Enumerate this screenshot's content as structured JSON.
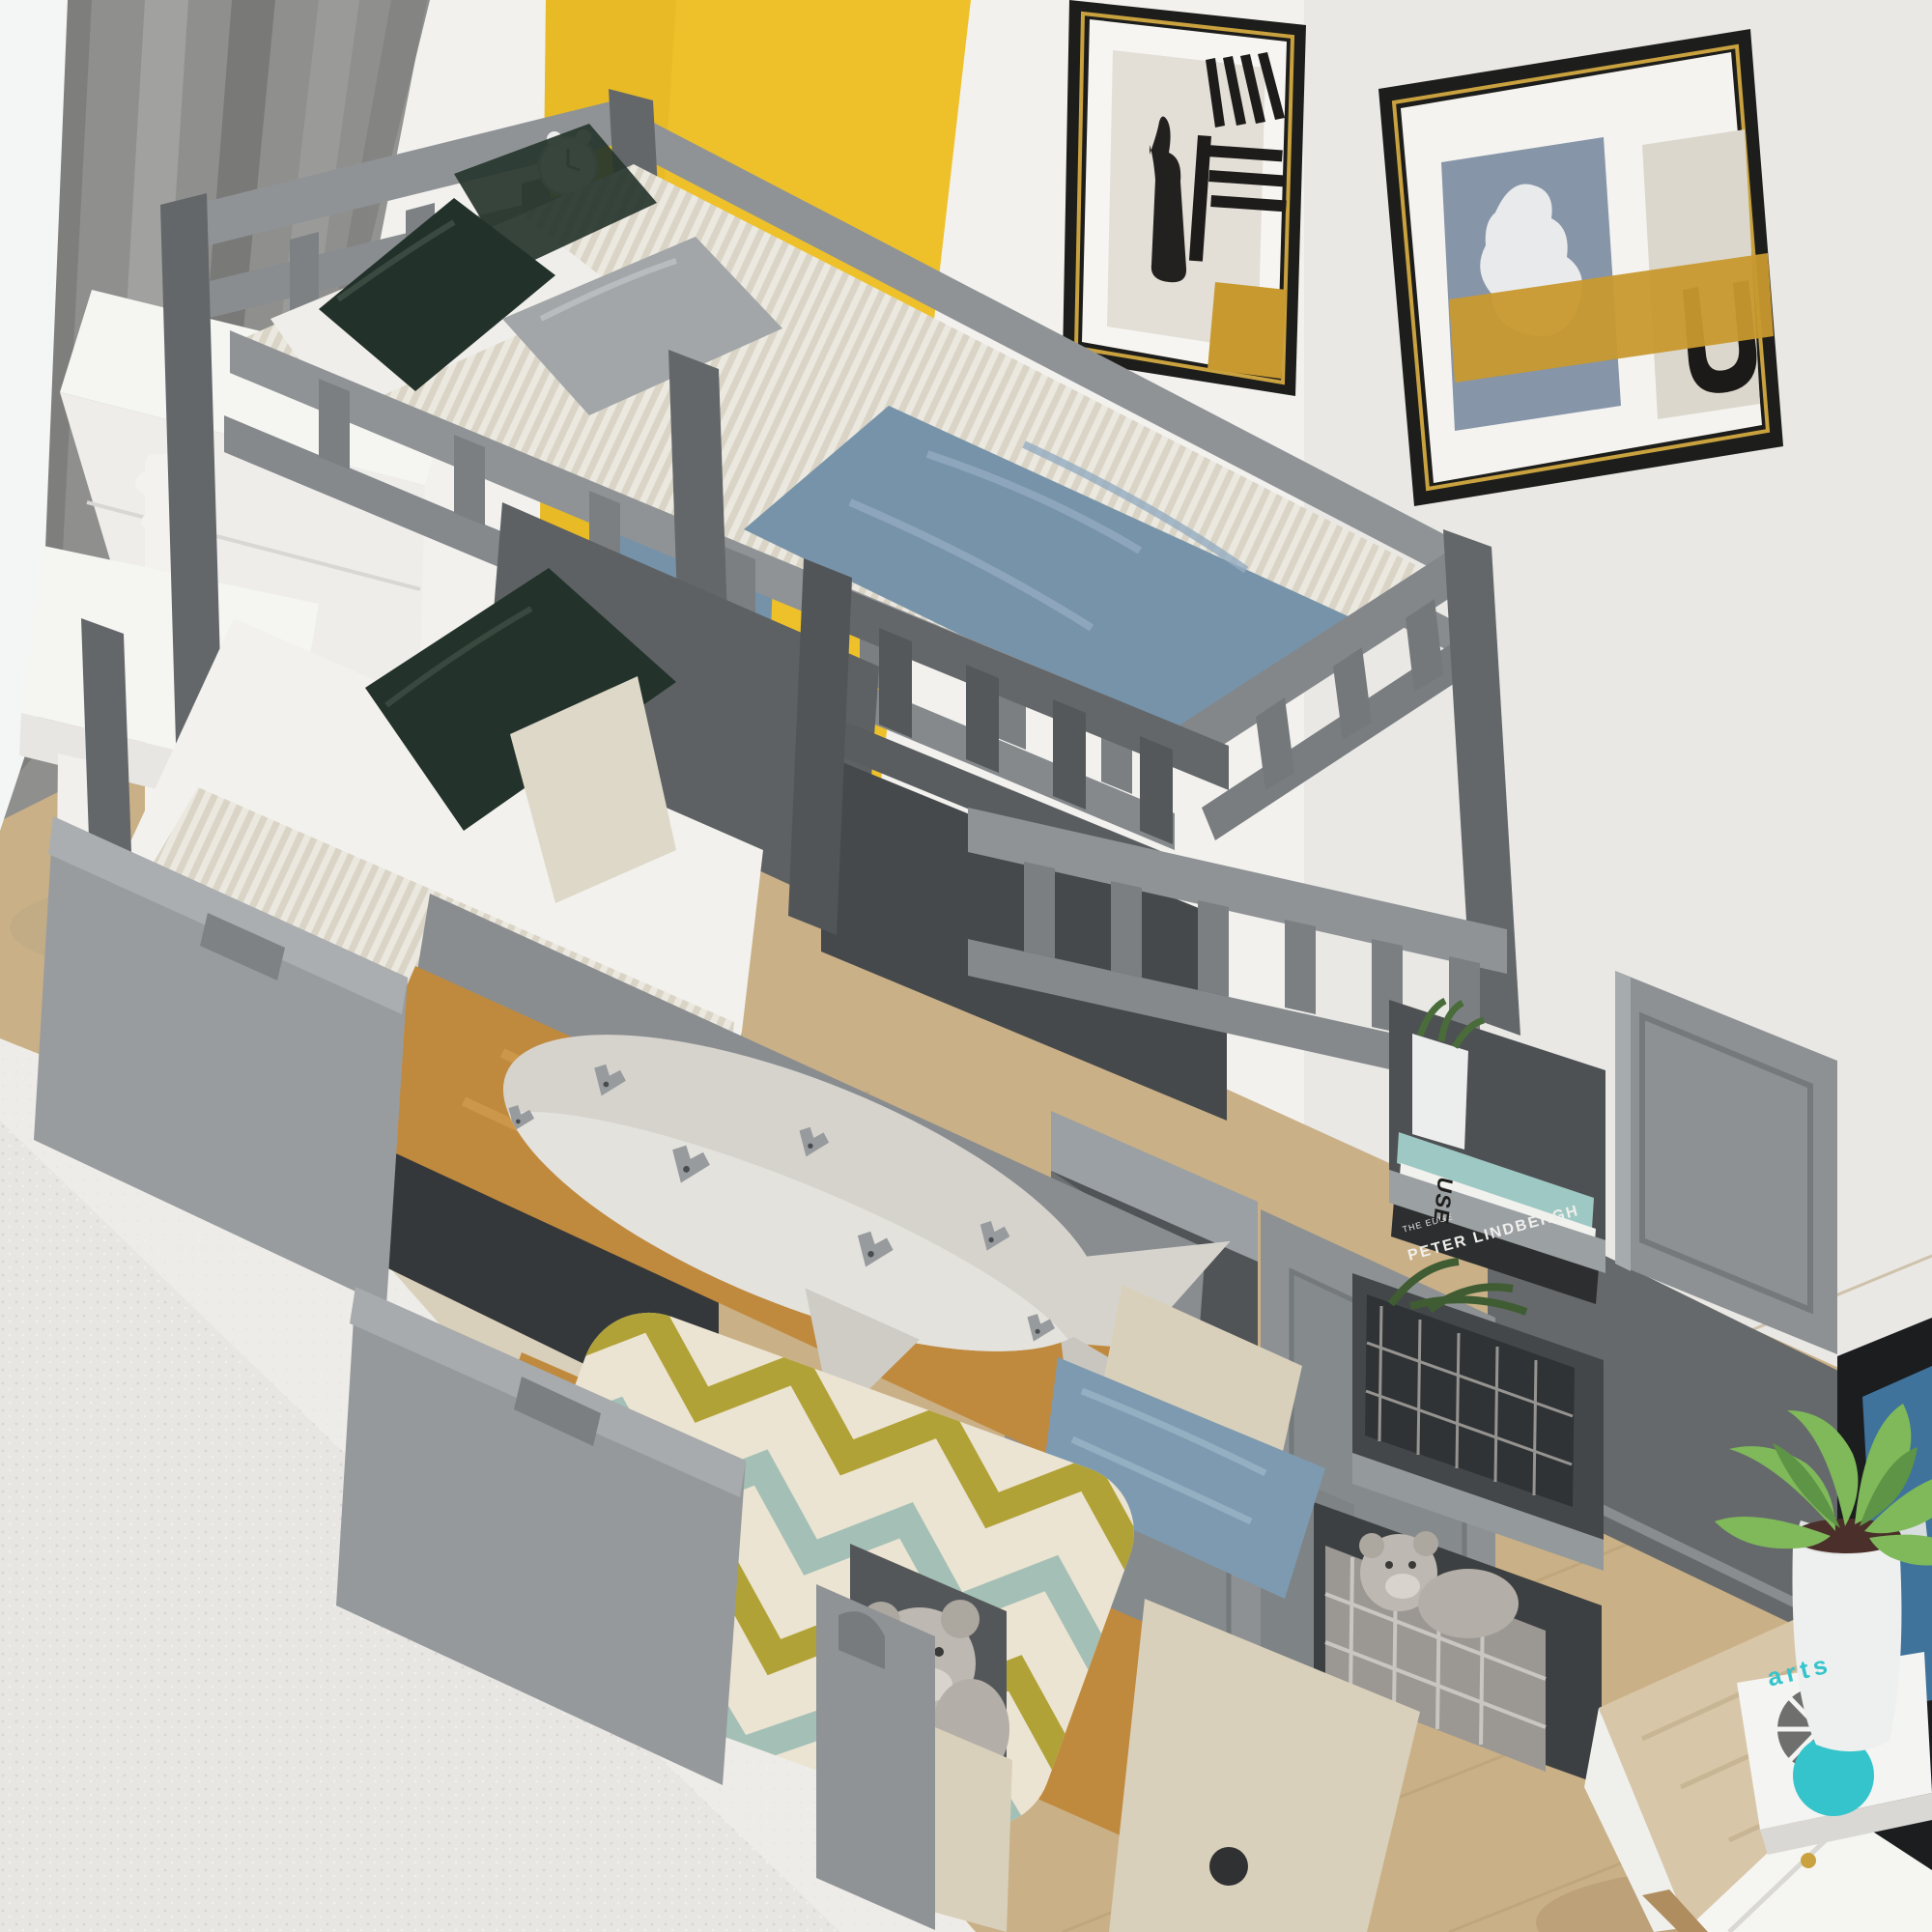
{
  "meta": {
    "description": "Photograph of a kids bedroom with a gray wooden twin-over-twin bunk bed featuring a storage staircase with shelves, a pulled-out step drawer with a teddy bear, two open under-bed trundle drawers holding a shark plush and a chevron pillow, wall art, a white desk with stool, and a small side table with a plant."
  },
  "text": {
    "shelf_book_spine": "PETER LINDBERGH",
    "shelf_book_sub": "THE EDGE",
    "shelf_book_letters": "USE",
    "table_book_title": "arts"
  },
  "palette": {
    "wall": "#f2f1ee",
    "wallShade": "#e9e8e5",
    "accentYellow": "#eec12b",
    "curtain": "#8f8f8d",
    "sheer": "#f4f6f6",
    "bedGray": "#8f9396",
    "bedDark": "#63676a",
    "bedLight": "#a9adb0",
    "sheetWhite": "#f2f1ed",
    "blanketBlue": "#7793a9",
    "pillowGreen": "#26352d",
    "pillowGray": "#a2a6a8",
    "pillowCream": "#ded8c8",
    "drawerWood": "#c08a3e",
    "floorWood": "#cab086",
    "woodWhitewash": "#d9d0bb",
    "rug": "#e8e6e2",
    "frameBlack": "#1d1d1b",
    "frameGold": "#c9a23f",
    "artGold": "#c8992e",
    "artBlueGray": "#8795a8",
    "doorGray": "#8d9194",
    "shadowDark": "#3e4143",
    "plushCream": "#d6d3cd",
    "chevronBase": "#ece4d2",
    "chevronSage": "#a4c0b6",
    "chevronOlive": "#b1a238",
    "teal": "#35c4cb",
    "plantGreen": "#7fb95a",
    "tableWood": "#d8c6a8",
    "furnitureWhite": "#f5f5f2",
    "screenBlue": "#3f739c",
    "basketDark": "#303335",
    "teddy": "#bdb8b1",
    "bookTeal": "#9ec8c3",
    "spineDark": "#2c2e2f"
  }
}
